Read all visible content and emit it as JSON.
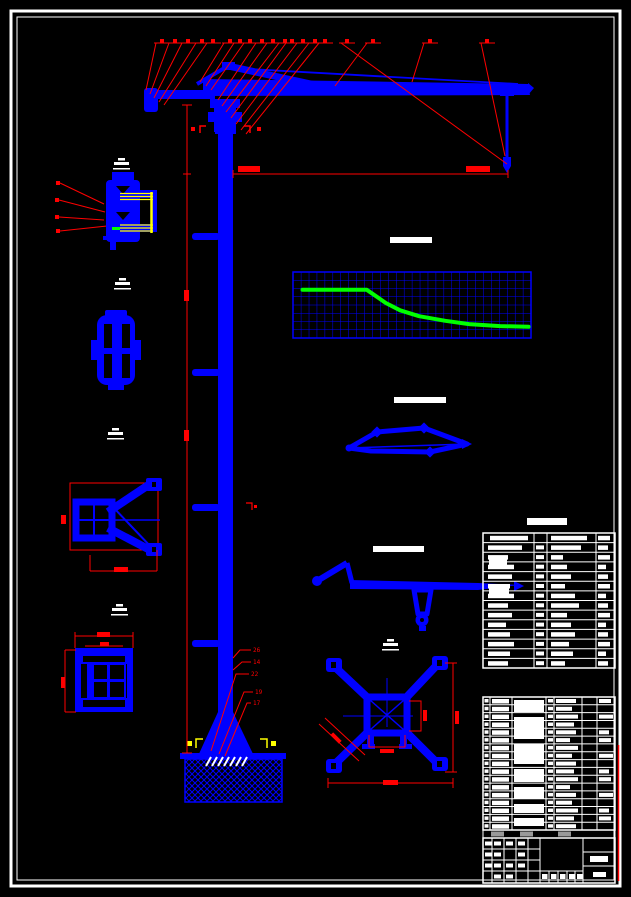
{
  "sheet": {
    "background": "#000000",
    "frame_color": "#ffffff",
    "drawing_color": "#0000ff",
    "dimension_color": "#ff0000",
    "highlight_color": "#ffff00",
    "curve_color": "#00ff00",
    "hatch_color": "#0000ff"
  },
  "callouts": {
    "tower_base_labels": [
      "26",
      "14",
      "22",
      "19",
      "17"
    ]
  },
  "chart_data": {
    "type": "line",
    "title": "",
    "xlabel": "",
    "ylabel": "",
    "grid": {
      "on": true,
      "cols": 30,
      "rows": 8
    },
    "axis_labels_visible": false,
    "series": [
      {
        "name": "load-curve",
        "x_frac": [
          0.04,
          0.31,
          0.39,
          0.45,
          0.53,
          0.64,
          0.74,
          0.87,
          0.99
        ],
        "y_frac": [
          0.27,
          0.27,
          0.47,
          0.58,
          0.67,
          0.74,
          0.79,
          0.82,
          0.83
        ]
      }
    ]
  },
  "tables": {
    "spec_table": {
      "rows": 14,
      "cols": 4
    },
    "parts_table": {
      "rows": 17,
      "cols": 7
    }
  }
}
